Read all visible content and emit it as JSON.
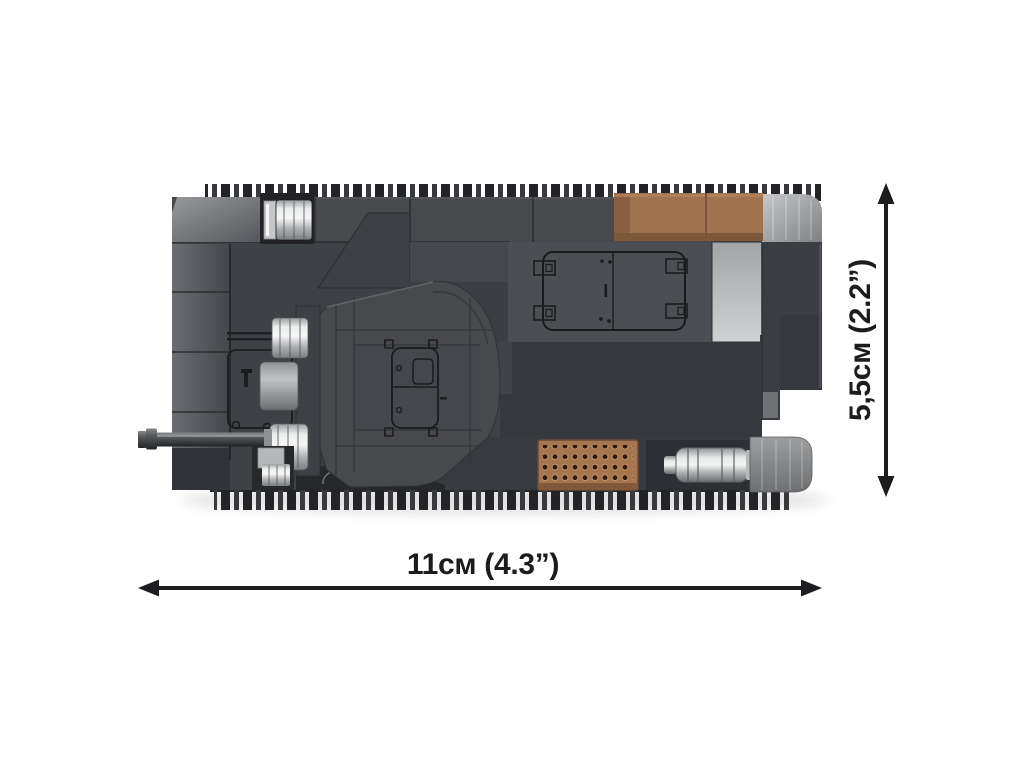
{
  "figure": {
    "subject": "COBI building-block tank model, top view with dimension arrows",
    "view": "top",
    "dimensions": {
      "width": {
        "label": "11см (4.3”)"
      },
      "height": {
        "label": "5,5см (2.2”)"
      }
    },
    "dimension_arrows": {
      "width": "double-headed horizontal arrow",
      "height": "double-headed vertical arrow"
    },
    "colors": {
      "background": "#ffffff",
      "dimension_ink": "#1d1d1f",
      "hull_dark": "#3e4145",
      "hull_mid": "#47494d",
      "hull_plate_light": "#4b4e52",
      "deck_shadow": "#35383c",
      "stowage_brown": "#a1724e",
      "grille_brown": "#a6764f",
      "track_light_gray": "#9ea0a2",
      "silver": "#c9cacc",
      "print_ink": "#1b1b1d"
    }
  }
}
